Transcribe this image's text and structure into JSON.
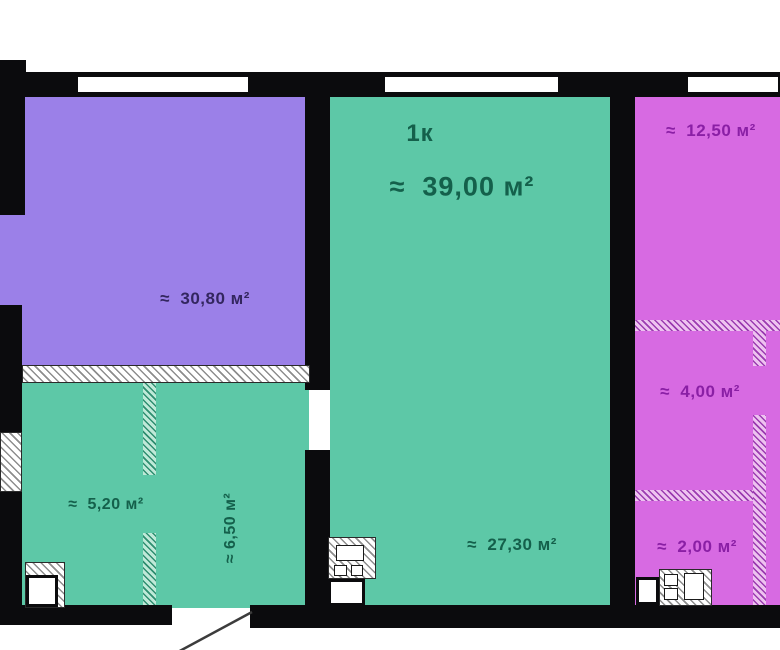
{
  "plan": {
    "unit_title": "1к",
    "unit_area": "≈  39,00 м²",
    "rooms": {
      "living": "≈  30,80 м²",
      "main": "≈  27,30 м²",
      "hall": "≈  5,20 м²",
      "corridor": "≈ 6,50 м²",
      "balcony": "≈  12,50 м²",
      "storage": "≈  4,00 м²",
      "bathroom": "≈  2,00 м²"
    },
    "colors": {
      "room_living_fill": "#9b80e8",
      "room_teal_fill": "#5dc8a7",
      "room_magenta_fill": "#d76ae2",
      "wall": "#0b0b0d",
      "text_living": "#33265f",
      "text_teal": "#14604b",
      "text_magenta": "#8a1fa5",
      "hatch_base": "#ffffff"
    }
  }
}
